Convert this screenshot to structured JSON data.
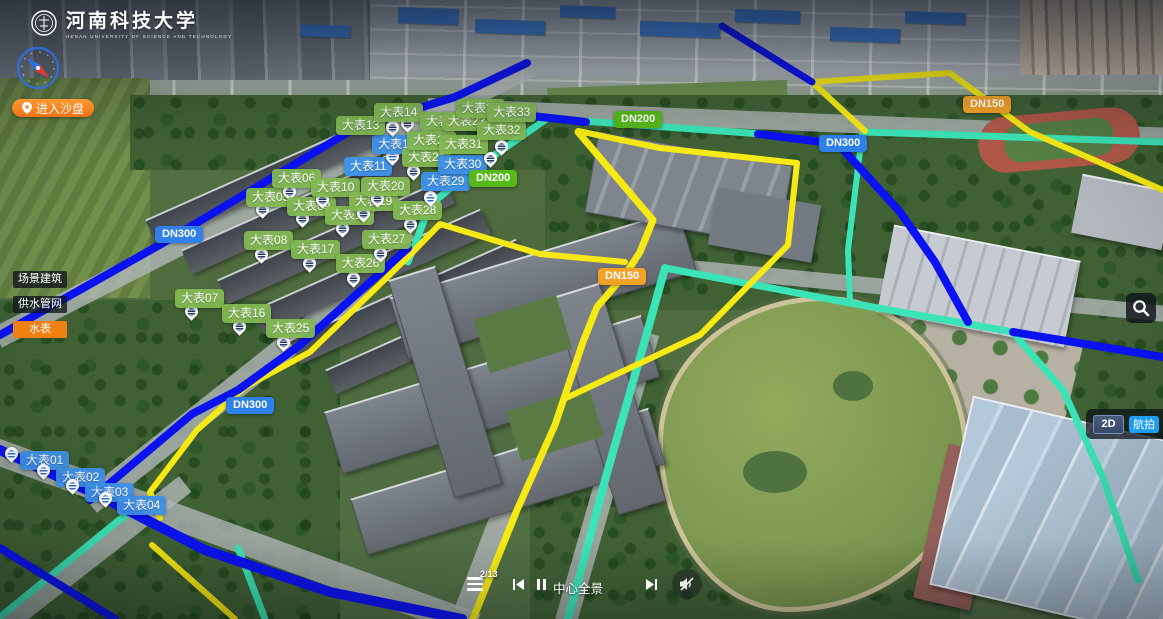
{
  "header": {
    "logo_text": "河南科技大学",
    "logo_subtext": "HENAN UNIVERSITY OF SCIENCE AND TECHNOLOGY"
  },
  "toolbar": {
    "enter_sandbox": "进入沙盘"
  },
  "legend": {
    "items": [
      {
        "key": "scene-buildings",
        "label": "场景建筑",
        "active": false
      },
      {
        "key": "water-pipes",
        "label": "供水管网",
        "active": false
      },
      {
        "key": "water-meters",
        "label": "水表",
        "active": true
      }
    ]
  },
  "controls": {
    "mode_2d": "2D",
    "mode_aerial": "航拍"
  },
  "player": {
    "counter": "2/13",
    "scene_label": "中心全景"
  },
  "colors": {
    "pipe_dn300": "#0a12f2",
    "pipe_dn150": "#f7ea14",
    "pipe_dn200": "#3be4b6",
    "marker_green": "#82b852",
    "marker_blue": "#3e91ea",
    "badge_dn300": "#2f80ea",
    "badge_dn150": "#f2a226",
    "badge_dn200": "#55ba1a",
    "accent_orange": "#f08012",
    "mode_active_blue": "#1f9cf4"
  },
  "markers": [
    {
      "label": "大表01",
      "color": "blue",
      "x": 20,
      "y": 451,
      "px": 5,
      "py": 447
    },
    {
      "label": "大表02",
      "color": "blue",
      "x": 56,
      "y": 468,
      "px": 37,
      "py": 464
    },
    {
      "label": "大表03",
      "color": "blue",
      "x": 85,
      "y": 483,
      "px": 66,
      "py": 479
    },
    {
      "label": "大表04",
      "color": "blue",
      "x": 117,
      "y": 496,
      "px": 99,
      "py": 492
    },
    {
      "label": "大表05",
      "color": "green",
      "x": 246,
      "y": 188,
      "px": 256,
      "py": 203
    },
    {
      "label": "大表06",
      "color": "green",
      "x": 272,
      "y": 169,
      "px": 283,
      "py": 185
    },
    {
      "label": "大表07",
      "color": "green",
      "x": 175,
      "y": 289,
      "px": 185,
      "py": 305
    },
    {
      "label": "大表08",
      "color": "green",
      "x": 244,
      "y": 231,
      "px": 255,
      "py": 248
    },
    {
      "label": "大表09",
      "color": "green",
      "x": 287,
      "y": 197,
      "px": 296,
      "py": 212
    },
    {
      "label": "大表10",
      "color": "green",
      "x": 311,
      "y": 178,
      "px": 316,
      "py": 193
    },
    {
      "label": "大表11",
      "color": "blue",
      "x": 344,
      "y": 157,
      "px": 381,
      "py": 155
    },
    {
      "label": "大表12",
      "color": "blue",
      "x": 372,
      "y": 135,
      "px": 386,
      "py": 150
    },
    {
      "label": "大表13",
      "color": "green",
      "x": 336,
      "y": 116,
      "px": 386,
      "py": 121
    },
    {
      "label": "大表14",
      "color": "green",
      "x": 374,
      "y": 103,
      "px": 401,
      "py": 117
    },
    {
      "label": "大表15",
      "color": "green",
      "x": 420,
      "y": 112
    },
    {
      "label": "大表16",
      "color": "green",
      "x": 222,
      "y": 304,
      "px": 233,
      "py": 320
    },
    {
      "label": "大表17",
      "color": "green",
      "x": 291,
      "y": 240,
      "px": 303,
      "py": 257
    },
    {
      "label": "大表18",
      "color": "green",
      "x": 325,
      "y": 206,
      "px": 336,
      "py": 222
    },
    {
      "label": "大表19",
      "color": "green",
      "x": 349,
      "y": 192,
      "px": 357,
      "py": 207
    },
    {
      "label": "大表20",
      "color": "green",
      "x": 361,
      "y": 177,
      "px": 371,
      "py": 192
    },
    {
      "label": "大表21",
      "color": "green",
      "x": 402,
      "y": 148,
      "px": 407,
      "py": 165
    },
    {
      "label": "大表22",
      "color": "green",
      "x": 407,
      "y": 131
    },
    {
      "label": "大表23",
      "color": "green",
      "x": 442,
      "y": 112
    },
    {
      "label": "大表24",
      "color": "green",
      "x": 456,
      "y": 99
    },
    {
      "label": "大表25",
      "color": "green",
      "x": 266,
      "y": 319,
      "px": 277,
      "py": 336
    },
    {
      "label": "大表26",
      "color": "green",
      "x": 336,
      "y": 254,
      "px": 347,
      "py": 272
    },
    {
      "label": "大表27",
      "color": "green",
      "x": 362,
      "y": 230,
      "px": 374,
      "py": 247
    },
    {
      "label": "大表28",
      "color": "green",
      "x": 393,
      "y": 201,
      "px": 404,
      "py": 218
    },
    {
      "label": "大表29",
      "color": "blue",
      "x": 421,
      "y": 172,
      "px": 424,
      "py": 191
    },
    {
      "label": "大表30",
      "color": "blue",
      "x": 438,
      "y": 155,
      "px": 472,
      "py": 168
    },
    {
      "label": "大表31",
      "color": "green",
      "x": 439,
      "y": 135,
      "px": 484,
      "py": 152
    },
    {
      "label": "大表32",
      "color": "green",
      "x": 477,
      "y": 121,
      "px": 495,
      "py": 140
    },
    {
      "label": "大表33",
      "color": "green",
      "x": 487,
      "y": 103
    }
  ],
  "pipe_labels": [
    {
      "label": "DN300",
      "type": "dn300",
      "x": 155,
      "y": 226
    },
    {
      "label": "DN300",
      "type": "dn300",
      "x": 226,
      "y": 397
    },
    {
      "label": "DN300",
      "type": "dn300",
      "x": 819,
      "y": 135
    },
    {
      "label": "DN150",
      "type": "dn150",
      "x": 598,
      "y": 268
    },
    {
      "label": "DN150",
      "type": "dn150",
      "x": 963,
      "y": 96
    },
    {
      "label": "DN200",
      "type": "dn200",
      "x": 469,
      "y": 170
    },
    {
      "label": "DN200",
      "type": "dn200",
      "x": 614,
      "y": 111
    }
  ],
  "pipes": [
    {
      "system": "DN200",
      "color": "#3be4b6",
      "width": 7,
      "points": "583,121 762,134"
    },
    {
      "system": "DN200",
      "color": "#3be4b6",
      "width": 7,
      "points": "548,118 470,172 430,205 408,262"
    },
    {
      "system": "DN200",
      "color": "#3be4b6",
      "width": 7,
      "points": "865,132 1163,142"
    },
    {
      "system": "DN200",
      "color": "#3be4b6",
      "width": 6,
      "points": "862,135 848,250 850,301"
    },
    {
      "system": "DN200",
      "color": "#3be4b6",
      "width": 8,
      "points": "665,268 645,340 607,473 568,619"
    },
    {
      "system": "DN200",
      "color": "#3be4b6",
      "width": 7,
      "points": "665,268 850,303 1013,332"
    },
    {
      "system": "DN200",
      "color": "#3be4b6",
      "width": 7,
      "points": "1015,335 1063,390 1103,478 1138,580"
    },
    {
      "system": "DN200",
      "color": "#3be4b6",
      "width": 7,
      "points": "150,498 118,521 0,617"
    },
    {
      "system": "DN200",
      "color": "#3be4b6",
      "width": 7,
      "points": "238,548 265,619"
    },
    {
      "system": "DN150",
      "color": "#f7ea14",
      "width": 6,
      "points": "812,82 950,73 1030,132 1163,190"
    },
    {
      "system": "DN150",
      "color": "#f7ea14",
      "width": 6,
      "points": "812,82 865,131"
    },
    {
      "system": "DN150",
      "color": "#f7ea14",
      "width": 6,
      "points": "578,131 660,148 797,163"
    },
    {
      "system": "DN150",
      "color": "#f7ea14",
      "width": 6,
      "points": "797,163 788,245 700,335 566,398"
    },
    {
      "system": "DN150",
      "color": "#f7ea14",
      "width": 7,
      "points": "578,132 653,220 640,252 627,272 597,307 583,342 555,425 517,510 473,619"
    },
    {
      "system": "DN150",
      "color": "#f7ea14",
      "width": 6,
      "points": "625,262 540,254 440,224 410,255 310,352 245,387 197,430 150,492 160,518"
    },
    {
      "system": "DN150",
      "color": "#f7ea14",
      "width": 6,
      "points": "152,545 235,619"
    },
    {
      "system": "DN300",
      "color": "#0a12f2",
      "width": 8,
      "points": "0,335 163,243 357,127 455,97 527,63"
    },
    {
      "system": "DN300",
      "color": "#0a12f2",
      "width": 8,
      "points": "460,108 586,122"
    },
    {
      "system": "DN300",
      "color": "#0a12f2",
      "width": 8,
      "points": "758,134 838,144 900,212 935,262 968,322"
    },
    {
      "system": "DN300",
      "color": "#0a12f2",
      "width": 10,
      "points": "0,450 100,496 205,550 330,592 462,619"
    },
    {
      "system": "DN300",
      "color": "#0a12f2",
      "width": 8,
      "points": "408,248 300,345 238,390 192,414 90,500"
    },
    {
      "system": "DN300",
      "color": "#0a12f2",
      "width": 7,
      "points": "722,26 812,82"
    },
    {
      "system": "DN300",
      "color": "#0a12f2",
      "width": 8,
      "points": "0,548 115,619"
    },
    {
      "system": "DN300",
      "color": "#0a12f2",
      "width": 8,
      "points": "1013,332 1163,357"
    }
  ]
}
